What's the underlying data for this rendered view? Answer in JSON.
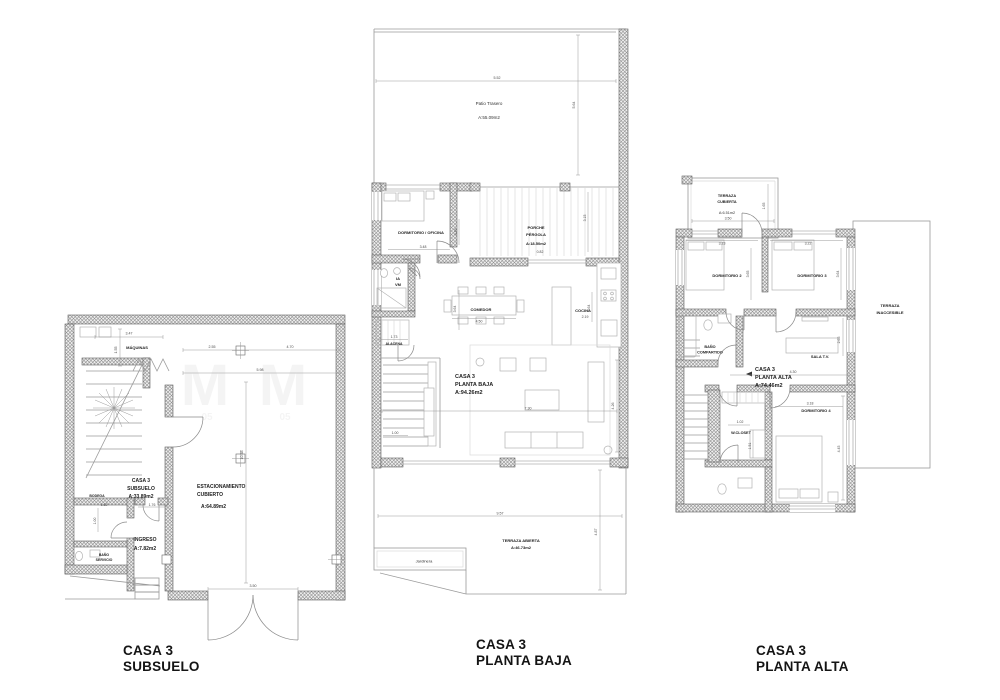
{
  "drawing": {
    "watermark": {
      "m": "M",
      "num": "05"
    },
    "subsuelo": {
      "title_line1": "CASA 3",
      "title_line2": "SUBSUELO",
      "rooms": {
        "maquinas": "MÁQUINAS",
        "casa_l1": "CASA 3",
        "casa_l2": "SUBSUELO",
        "casa_area": "A:33.89m2",
        "estacionamiento_l1": "ESTACIONAMIENTO",
        "estacionamiento_l2": "CUBIERTO",
        "estacionamiento_area": "A:64.89m2",
        "ingreso": "INGRESO",
        "ingreso_area": "A:7.82m2",
        "bodega": "BODEGA",
        "bano_l1": "BAÑO",
        "bano_l2": "SERVICIO"
      },
      "dims": {
        "w_maquinas": "3.47",
        "h_maquinas": "1.55",
        "w_col1": "2.55",
        "w_col2": "4.70",
        "w_garaje": "5.98",
        "h_garaje": "10.58",
        "w_bodega": "1.62",
        "h_bodega": "1.00",
        "w_ingreso": "1.76",
        "w_porton": "3.50"
      }
    },
    "planta_baja": {
      "title_line1": "CASA 3",
      "title_line2": "PLANTA BAJA",
      "rooms": {
        "patio": "Patio Trasero",
        "patio_area": "A:55.09m2",
        "dormitorio_oficina": "DORMITORIO / OFICINA",
        "porche_l1": "PORCHE",
        "porche_l2": "PÉRGOLA",
        "porche_area": "A:18.50m2",
        "medio_bano_l1": "IA",
        "medio_bano_l2": "VM",
        "alacena": "ALACENA",
        "comedor": "COMEDOR",
        "cocina": "COCINA",
        "casa_l1": "CASA 3",
        "casa_l2": "PLANTA BAJA",
        "casa_area": "A:94.26m2",
        "terraza": "TERRAZA ABIERTA",
        "terraza_area": "A:46.73m2",
        "jardinera": "Jardinera"
      },
      "dims": {
        "w_patio": "5.52",
        "h_patio": "5.64",
        "h_dorm": "3.29",
        "w_dorm": "3.48",
        "h_porche": "3.15",
        "w_paso": "0.82",
        "w_alacena": "1.73",
        "h_comedor": "3.64",
        "w_comedor": "4.50",
        "w_cocina": "2.19",
        "h_cocina": "3.64",
        "w_sala": "7.30",
        "h_sala": "4.26",
        "w_escalera": "1.00",
        "w_terraza": "9.57",
        "h_terraza": "4.87"
      }
    },
    "planta_alta": {
      "title_line1": "CASA 3",
      "title_line2": "PLANTA ALTA",
      "rooms": {
        "terraza_cub_l1": "TERRAZA",
        "terraza_cub_l2": "CUBIERTA",
        "terraza_cub_area": "A:6.51m2",
        "dormitorio2": "DORMITORIO 2",
        "dormitorio3": "DORMITORIO 3",
        "terraza_inac_l1": "TERRAZA",
        "terraza_inac_l2": "INACCESIBLE",
        "bano_l1": "BAÑO",
        "bano_l2": "COMPARTIDO",
        "sala_tv": "SALA T.V.",
        "casa_l1": "CASA 3",
        "casa_l2": "PLANTA ALTA",
        "casa_area": "A:74.46m2",
        "wcloset": "W.CLOSET",
        "dormitorio4": "DORMITORIO 4"
      },
      "dims": {
        "w_terraza": "3.50",
        "h_terraza": "1.65",
        "w_dorm2": "3.23",
        "w_dorm3": "3.22",
        "h_dorm2": "3.65",
        "h_dorm3": "3.64",
        "h_sala": "2.65",
        "w_pasillo": "4.30",
        "w_dorm4": "3.18",
        "w_closet": "1.02",
        "h_closet": "1.51",
        "h_dorm4": "4.45"
      }
    }
  }
}
